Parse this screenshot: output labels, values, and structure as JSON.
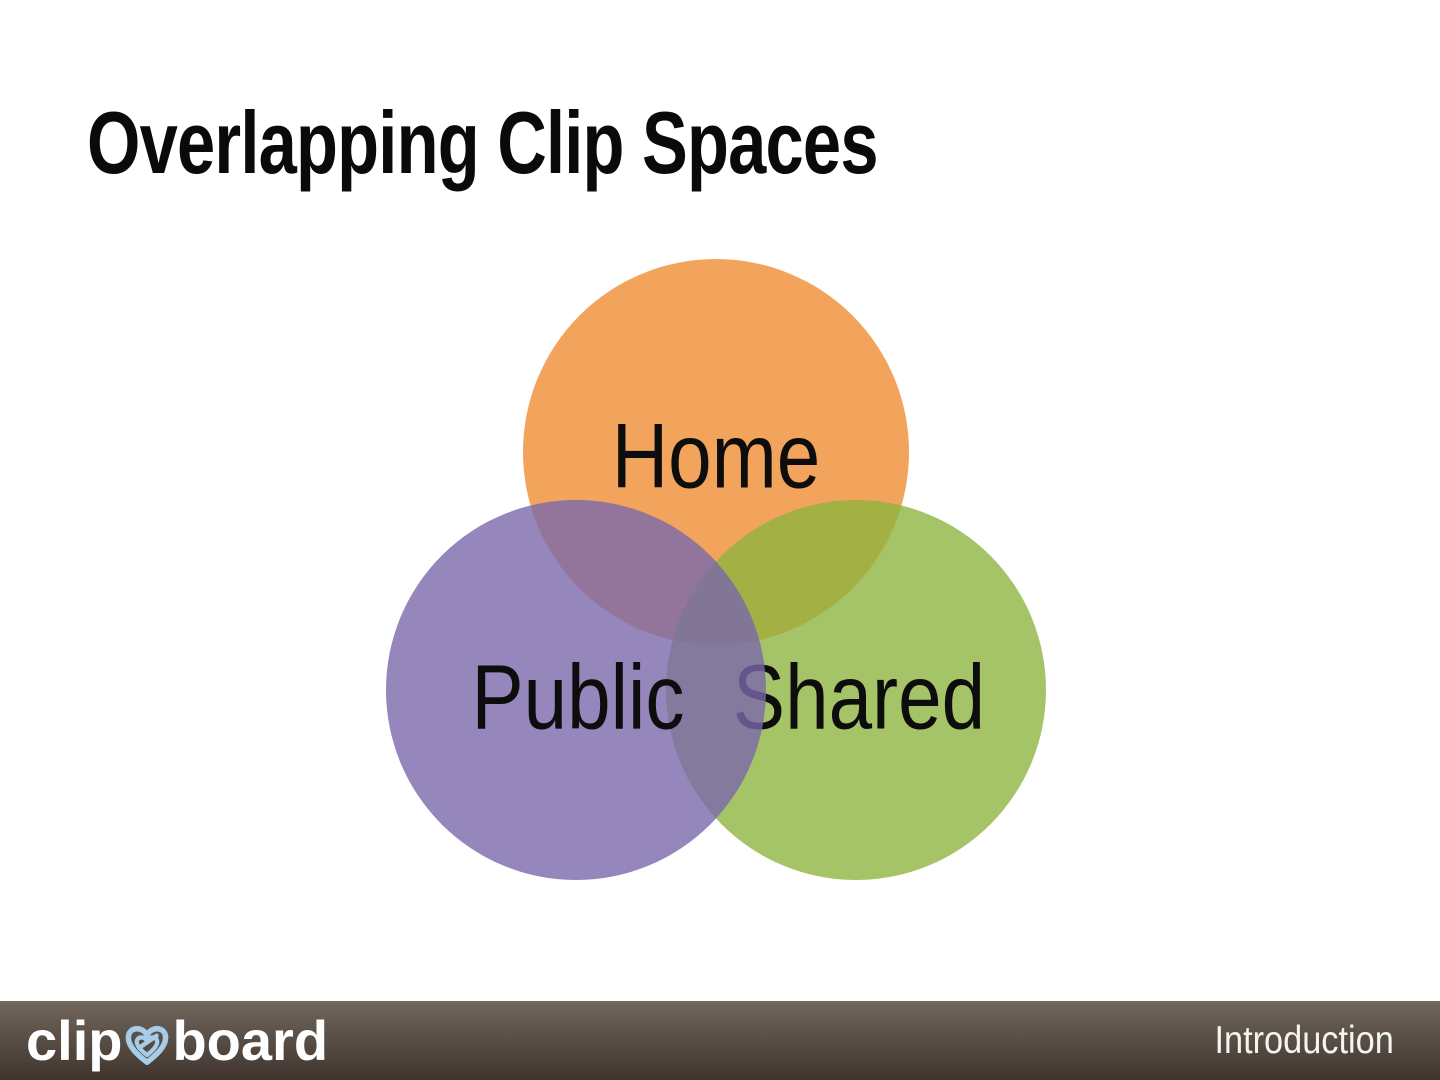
{
  "slide": {
    "title": "Overlapping Clip Spaces",
    "venn": {
      "type": "venn-diagram",
      "circles": [
        {
          "id": "home",
          "label": "Home",
          "fill": "#F2A45C"
        },
        {
          "id": "shared",
          "label": "Shared",
          "fill": "rgba(140,179,62,0.78)"
        },
        {
          "id": "public",
          "label": "Public",
          "fill": "rgba(123,104,171,0.80)"
        }
      ],
      "label_color": "#0d0d0d"
    },
    "footer": {
      "brand_part1": "clip",
      "brand_part2": "board",
      "heart_color": "#A7CCE7",
      "section_label": "Introduction",
      "background_top": "#6F655B",
      "background_bottom": "#3F352E",
      "text_color": "#FFFFFF"
    },
    "background_color": "#FFFFFF",
    "title_color": "#0A0A0A"
  }
}
